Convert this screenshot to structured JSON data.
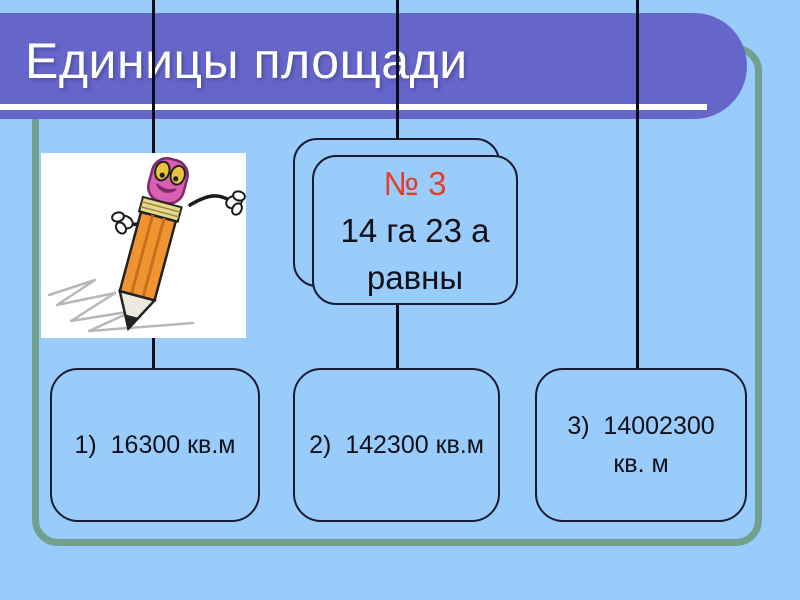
{
  "title": "Единицы площади",
  "question_card": {
    "number": "№ 3",
    "line1": "14 га 23 а",
    "line2": "равны"
  },
  "answers": [
    {
      "line1": "1)  16300 кв.м",
      "line2": ""
    },
    {
      "line1": "2)  142300 кв.м",
      "line2": ""
    },
    {
      "line1": "3)  14002300",
      "line2": "кв. м"
    }
  ],
  "icons": {
    "clipart": "pencil-cartoon"
  },
  "colors": {
    "background": "#9accfb",
    "title_bar": "#6565ca",
    "title_text": "#ffffff",
    "frame_border": "#71a18e",
    "connector_line": "#0d0d18",
    "box_border": "#1b1b32",
    "box_fill": "#9accfb",
    "question_number": "#e73c28",
    "body_text": "#101018"
  }
}
